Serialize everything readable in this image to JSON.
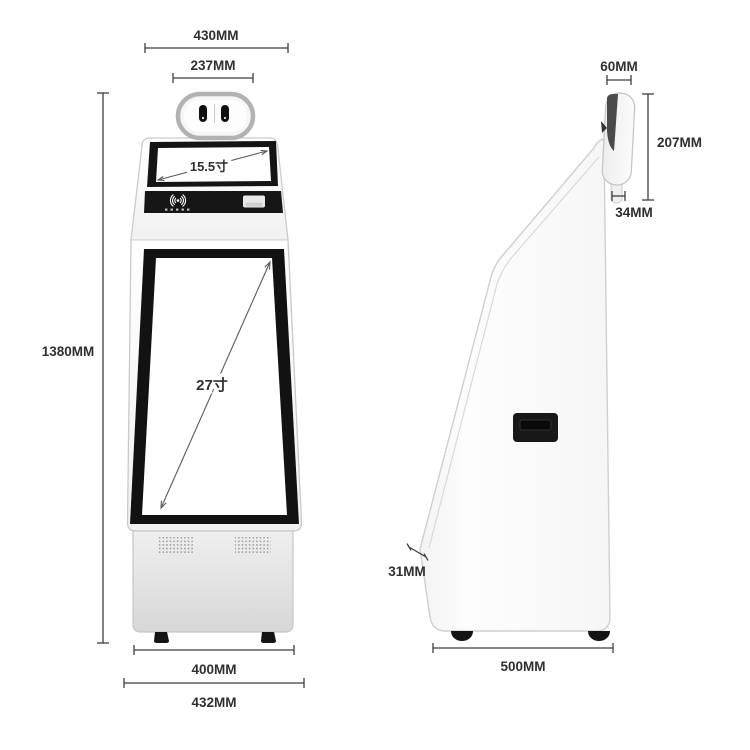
{
  "front_view": {
    "dims": {
      "top_width": "430MM",
      "camera_pod_width": "237MM",
      "total_height": "1380MM",
      "base_width_inner": "400MM",
      "base_width_outer": "432MM"
    },
    "screens": {
      "top_screen_diagonal": "15.5寸",
      "main_screen_diagonal": "27寸"
    }
  },
  "side_view": {
    "dims": {
      "camera_pod_depth": "60MM",
      "camera_pod_height": "207MM",
      "camera_mount_height": "34MM",
      "screen_edge_thickness": "31MM",
      "base_depth": "500MM"
    }
  },
  "colors": {
    "background": "#ffffff",
    "dimension_lines": "#3f3f3f",
    "label_text": "#2f2f2f",
    "screen_bezel": "#141414",
    "kiosk_body": "#fafafa",
    "kiosk_outline": "#c9c9c9",
    "base_cabinet": "#e0e0e0",
    "feet": "#151515"
  }
}
